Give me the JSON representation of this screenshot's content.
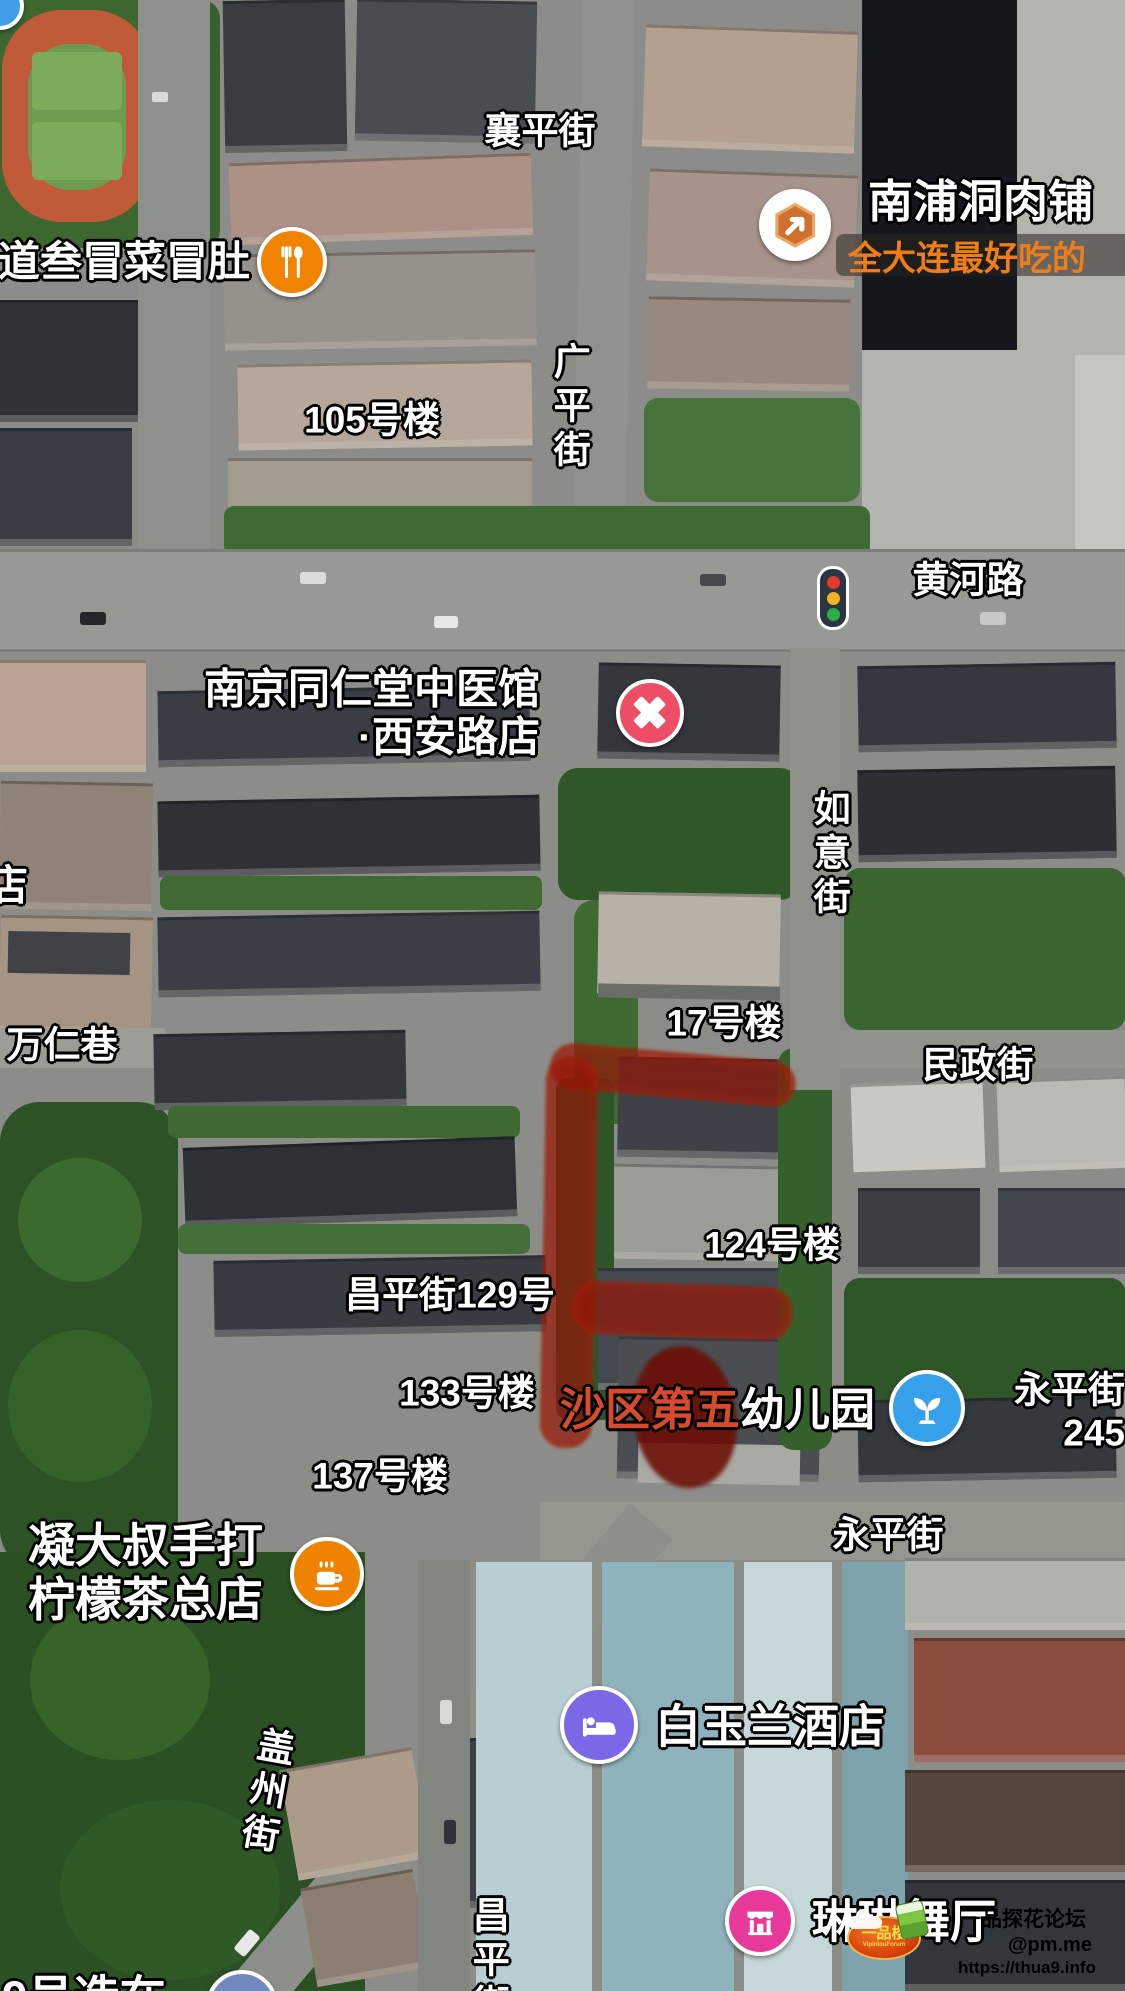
{
  "app": {
    "view": "satellite-map"
  },
  "streets": [
    {
      "name": "襄平街",
      "x": 540,
      "y": 132,
      "orientation": "horizontal"
    },
    {
      "name": "广平街",
      "x": 568,
      "y": 408,
      "orientation": "vertical"
    },
    {
      "name": "黄河路",
      "x": 968,
      "y": 581,
      "orientation": "horizontal"
    },
    {
      "name": "如意街",
      "x": 828,
      "y": 855,
      "orientation": "vertical"
    },
    {
      "name": "万仁巷",
      "x": 62,
      "y": 1046,
      "orientation": "horizontal"
    },
    {
      "name": "民政街",
      "x": 978,
      "y": 1066,
      "orientation": "horizontal"
    },
    {
      "name": "永平街",
      "x": 888,
      "y": 1536,
      "orientation": "horizontal"
    },
    {
      "name": "盖州街",
      "x": 264,
      "y": 1792,
      "orientation": "vertical",
      "tilt": 10
    },
    {
      "name": "昌平街",
      "x": 487,
      "y": 1962,
      "orientation": "vertical"
    }
  ],
  "street_edge_label": {
    "lines": [
      "永平街",
      "245"
    ],
    "x": 997,
    "y": 1412
  },
  "buildings": [
    {
      "name": "105号楼",
      "x": 372,
      "y": 421
    },
    {
      "name": "17号楼",
      "x": 724,
      "y": 1024
    },
    {
      "name": "124号楼",
      "x": 772,
      "y": 1246
    },
    {
      "name": "昌平街129号",
      "x": 450,
      "y": 1296
    },
    {
      "name": "133号楼",
      "x": 467,
      "y": 1394
    },
    {
      "name": "137号楼",
      "x": 380,
      "y": 1477
    }
  ],
  "pois": [
    {
      "id": "maocai-restaurant",
      "name": "道叁冒菜冒肚",
      "icon": "restaurant-icon",
      "icon_color": "#f08300",
      "icon_x": 292,
      "icon_y": 262,
      "icon_r": 35,
      "label_x": 250,
      "label_y": 262,
      "anchor": "right",
      "font": 42
    },
    {
      "id": "nanpudong-meat-shop",
      "name": "南浦洞肉铺",
      "subtitle": "全大连最好吃的",
      "subtitle_color": "#ef7d1a",
      "icon": "arrow-badge-icon",
      "icon_color": "#ffffff",
      "icon_x": 795,
      "icon_y": 225,
      "icon_r": 36,
      "label_x": 868,
      "label_y": 202,
      "anchor": "left",
      "font": 45
    },
    {
      "id": "tongrentang-clinic",
      "lines": [
        "南京同仁堂中医馆",
        "·西安路店"
      ],
      "icon": "medical-cross-icon",
      "icon_color": "#ee4d66",
      "icon_x": 650,
      "icon_y": 713,
      "icon_r": 34,
      "label_x": 540,
      "label_y": 714,
      "anchor": "right",
      "font": 42
    },
    {
      "id": "shaqu-5th-kindergarten",
      "name_red": "沙区第五",
      "name_white": "幼儿园",
      "icon": "seedling-icon",
      "icon_color": "#36a0ea",
      "icon_x": 927,
      "icon_y": 1408,
      "icon_r": 38,
      "label_x": 560,
      "label_y": 1410,
      "anchor": "left",
      "font": 45
    },
    {
      "id": "lemon-tea-shop",
      "lines": [
        "凝大叔手打",
        "柠檬茶总店"
      ],
      "icon": "coffee-cup-icon",
      "icon_color": "#ef8200",
      "icon_x": 327,
      "icon_y": 1574,
      "icon_r": 37,
      "label_x": 28,
      "label_y": 1573,
      "anchor": "left-block",
      "font": 47
    },
    {
      "id": "magnolia-hotel",
      "name": "白玉兰酒店",
      "icon": "bed-icon",
      "icon_color": "#7a68e6",
      "icon_x": 599,
      "icon_y": 1725,
      "icon_r": 39,
      "label_x": 655,
      "label_y": 1727,
      "anchor": "left",
      "font": 46
    },
    {
      "id": "linlin-dance-hall",
      "name": "琳琳舞厅",
      "icon": "stage-icon",
      "icon_color": "#e8399b",
      "icon_x": 760,
      "icon_y": 1921,
      "icon_r": 35,
      "label_x": 812,
      "label_y": 1922,
      "anchor": "left",
      "font": 46
    }
  ],
  "partial_labels": [
    {
      "text": "店",
      "x": -14,
      "y": 886,
      "font": 42
    },
    {
      "text": "9号造在",
      "x": 2,
      "y": 1998,
      "font": 46
    }
  ],
  "partial_icons": [
    {
      "id": "top-left-poi",
      "x": 0,
      "y": 6,
      "r": 24,
      "color": "#3f9ce8"
    },
    {
      "id": "bottom-left-poi",
      "x": 242,
      "y": 2006,
      "r": 36,
      "color": "#7488c0"
    }
  ],
  "traffic_light": {
    "x": 833,
    "y": 598,
    "colors": [
      "#e23b2e",
      "#f0b429",
      "#2fae47"
    ]
  },
  "annotation": {
    "tool": "hand-drawn-highlight",
    "stroke_color": "rgba(148,22,7,0.70)",
    "edge_color": "rgba(185,45,16,0.55)",
    "blob_color": "rgba(108,12,3,0.88)",
    "strokes": [
      {
        "x": 550,
        "y": 1052,
        "w": 246,
        "h": 46,
        "rot": 5
      },
      {
        "x": 543,
        "y": 1056,
        "w": 52,
        "h": 392,
        "rot": 1
      },
      {
        "x": 572,
        "y": 1284,
        "w": 220,
        "h": 53,
        "rot": 2
      }
    ],
    "blob": {
      "x": 634,
      "y": 1346,
      "w": 102,
      "h": 142,
      "rot": -8
    }
  },
  "watermark": {
    "forum": "一品探花论坛",
    "forum_color": "#c42640",
    "email": "@pm.me",
    "email_color": "#6d423c",
    "url": "https://thua9.info",
    "url_color": "#e9e9e7",
    "logo_text": "一品楼",
    "logo_subtext": "VipinlouForum"
  }
}
